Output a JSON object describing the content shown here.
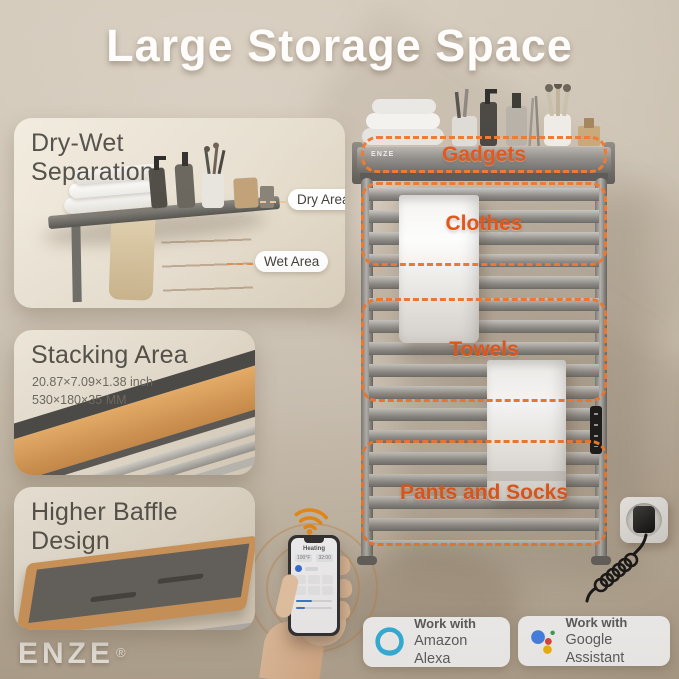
{
  "title": "Large Storage Space",
  "brand": {
    "logo_text": "ENZE",
    "reg_mark": "®"
  },
  "panels": {
    "dry_wet": {
      "title_line1": "Dry-Wet",
      "title_line2": "Separation",
      "dry_label": "Dry Area",
      "wet_label": "Wet Area"
    },
    "stacking": {
      "title": "Stacking Area",
      "size_inch": "20.87×7.09×1.38 inch",
      "size_mm": "530×180×35 MM"
    },
    "baffle": {
      "title_line1": "Higher Baffle",
      "title_line2": "Design"
    }
  },
  "rack": {
    "shelf_brand": "ENZE",
    "zones": [
      {
        "label": "Gadgets"
      },
      {
        "label": "Clothes"
      },
      {
        "label": "Towels"
      },
      {
        "label": "Pants and Socks"
      }
    ],
    "zone_accent_color": "#e4561a"
  },
  "phone": {
    "app_title": "Heating",
    "temperature": "100°F",
    "timer": "32:00"
  },
  "badges": [
    {
      "icon": "amazon-alexa-icon",
      "line1": "Work with",
      "line2": "Amazon Alexa"
    },
    {
      "icon": "google-assistant-icon",
      "line1": "Work with",
      "line2": "Google Assistant"
    }
  ],
  "colors": {
    "accent_orange": "#e4561a",
    "dashed_box_orange": "#ee7a32",
    "background_beige": "#cfc5b6",
    "panel_cream": "#ece5d8",
    "wifi_orange": "#ef8c15",
    "alexa_blue": "#2fb9e8",
    "google_blue": "#4285f4",
    "google_red": "#ea4335",
    "google_yellow": "#fbbc05",
    "google_green": "#34a853"
  }
}
